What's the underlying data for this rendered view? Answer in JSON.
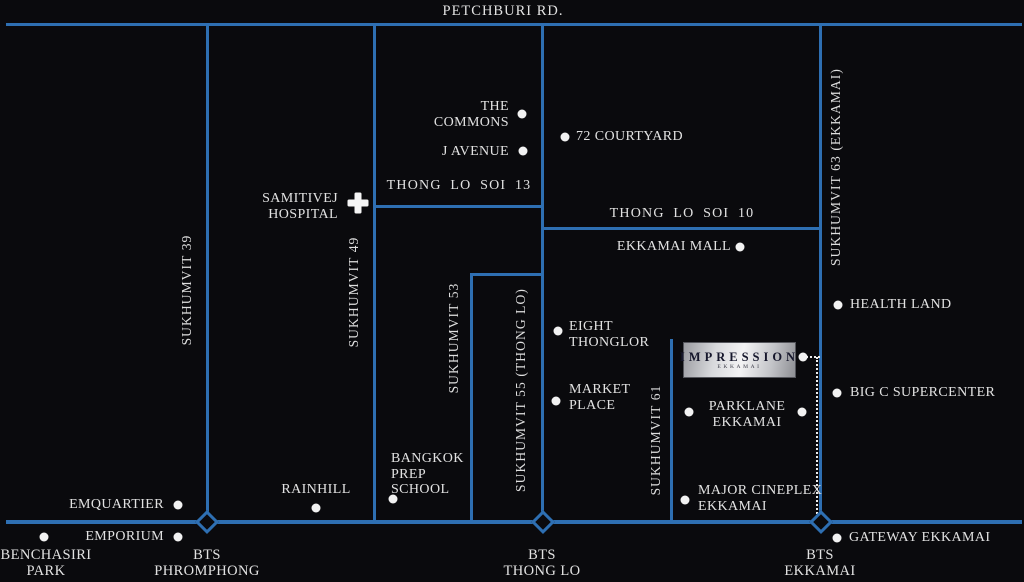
{
  "roads": {
    "petchburi": "PETCHBURI RD.",
    "sukhumvit39": "SUKHUMVIT 39",
    "sukhumvit49": "SUKHUMVIT 49",
    "sukhumvit53": "SUKHUMVIT 53",
    "sukhumvit55": "SUKHUMVIT 55 (THONG LO)",
    "sukhumvit61": "SUKHUMVIT 61",
    "sukhumvit63": "SUKHUMVIT 63 (EKKAMAI)",
    "thonglo_soi13": "THONG LO SOI 13",
    "thonglo_soi10": "THONG LO SOI 10"
  },
  "stations": {
    "phromphong": "BTS\nPHROMPHONG",
    "thonglo": "BTS\nTHONG LO",
    "ekkamai": "BTS\nEKKAMAI"
  },
  "landmarks": {
    "the_commons": "THE\nCOMMONS",
    "j_avenue": "J AVENUE",
    "courtyard72": "72 COURTYARD",
    "samitivej": "SAMITIVEJ\nHOSPITAL",
    "ekkamai_mall": "EKKAMAI MALL",
    "health_land": "HEALTH LAND",
    "eight_thonglor": "EIGHT\nTHONGLOR",
    "market_place": "MARKET\nPLACE",
    "big_c": "BIG C SUPERCENTER",
    "parklane": "PARKLANE\nEKKAMAI",
    "major_cineplex": "MAJOR CINEPLEX\nEKKAMAI",
    "bangkok_prep": "BANGKOK\nPREP\nSCHOOL",
    "rainhill": "RAINHILL",
    "emquartier": "EMQUARTIER",
    "emporium": "EMPORIUM",
    "benchasiri": "BENCHASIRI\nPARK",
    "gateway": "GATEWAY EKKAMAI"
  },
  "property": {
    "name": "IMPRESSION",
    "subtitle": "EKKAMAI"
  },
  "colors": {
    "background": "#0a0a0d",
    "road_blue": "#2e6fb2",
    "text": "#e2e2e2",
    "marker_white": "#f2f2f2",
    "property_text": "#16172c"
  }
}
